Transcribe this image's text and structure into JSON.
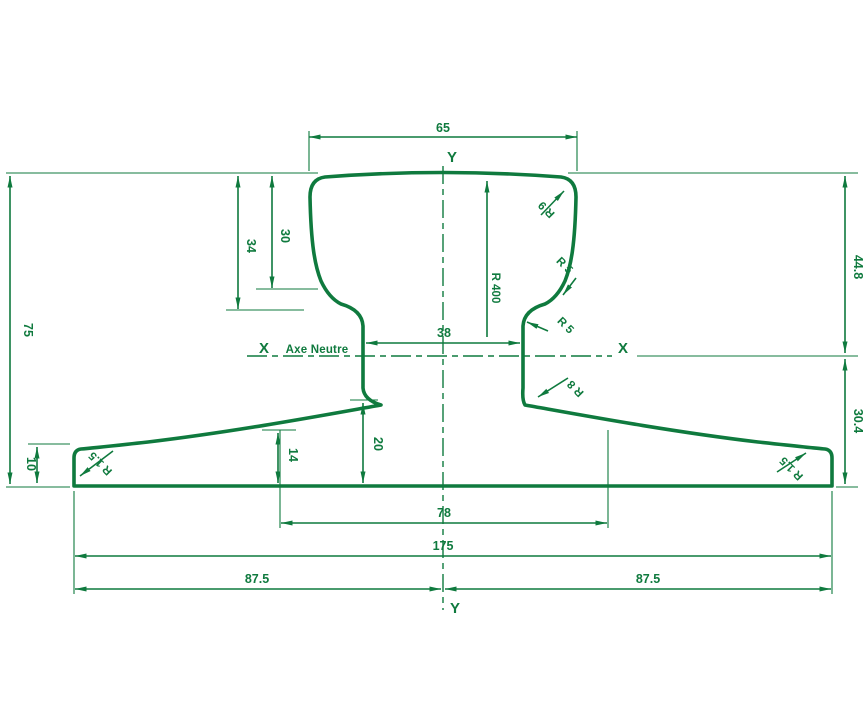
{
  "labels": {
    "y_axis_top": "Y",
    "y_axis_bottom": "Y",
    "x_axis_left": "X",
    "x_axis_right": "X",
    "neutral_axis": "Axe Neutre"
  },
  "dimensions": {
    "head_width": "65",
    "head_depth_outer": "34",
    "head_depth_inner": "30",
    "total_height": "75",
    "above_axis": "44.8",
    "below_axis": "30.4",
    "web_width": "38",
    "web_base_height": "20",
    "foot_thickness": "14",
    "foot_edge_thickness": "10",
    "foot_inner_width": "78",
    "foot_width": "175",
    "half_width_left": "87.5",
    "half_width_right": "87.5"
  },
  "radii": {
    "crown": "R 400",
    "head_corner": "R 9",
    "under_head": "R 5",
    "web_top": "R 5",
    "web_foot": "R 8",
    "foot_left": "R 1.5",
    "foot_right": "R 1.5"
  },
  "colors": {
    "line": "#0f7a3e",
    "background": "#ffffff"
  }
}
